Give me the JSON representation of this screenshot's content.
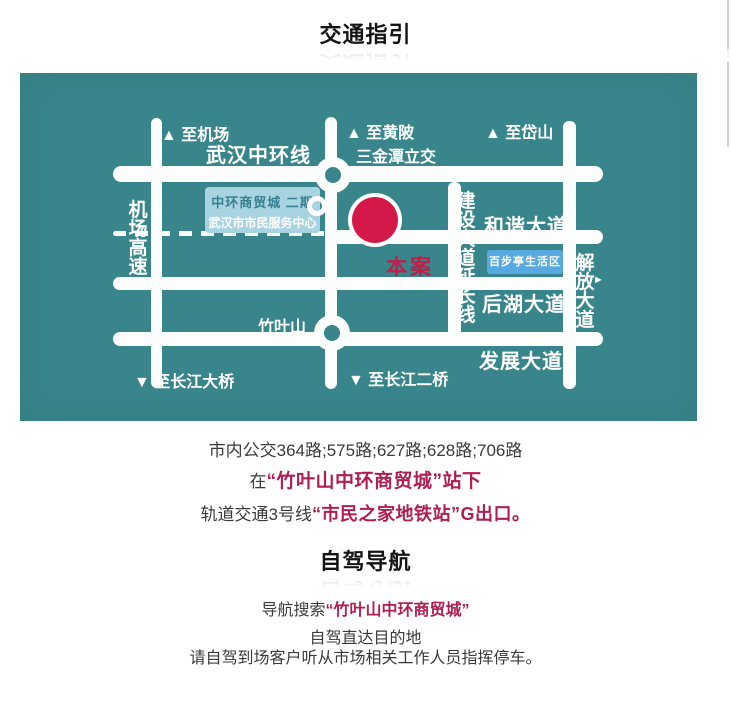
{
  "traffic_section": {
    "heading": "交通指引",
    "bus_line": "市内公交364路;575路;627路;628路;706路",
    "stop_line": {
      "prefix": "在",
      "highlight": "“竹叶山中环商贸城”站下"
    },
    "metro_line": {
      "prefix": "轨道交通3号线",
      "highlight": "“市民之家地铁站”G出口。"
    }
  },
  "driving_section": {
    "heading": "自驾导航",
    "nav_line": {
      "prefix": "导航搜索",
      "highlight": "“竹叶山中环商贸城”"
    },
    "direct_line": "自驾直达目的地",
    "note_line": "请自驾到场客户听从市场相关工作人员指挥停车。"
  },
  "map": {
    "colors": {
      "background": "#38858B",
      "road": "#FCFDFD",
      "site_marker": "#D4194A",
      "site_label": "#BE1E47",
      "info_box1_bg": "#A8D3E0",
      "info_box1_title": "#37808F",
      "info_box2_bg": "#58A9DF"
    },
    "labels": {
      "to_airport": "▲ 至机场",
      "wuhan_mid_ring": "武汉中环线",
      "to_huangpi": "▲ 至黄陂",
      "sanjintan_interchange": "三金潭立交",
      "to_daishan": "▲ 至岱山",
      "airport_expressway": "机场高速",
      "info_box1_title": "中环商贸城 二期",
      "info_box1_subtitle": "武汉市市民服务中心",
      "site_marker": "本案",
      "jianshe_ave_extension": "建设大道延长线",
      "harmony_ave": "和谐大道",
      "baibuting_area": "百步亭生活区",
      "jiefang_ave": "解放大道",
      "jiefang_arrow": "►",
      "houhu_ave": "后湖大道",
      "zhuyeshan": "竹叶山",
      "fazhan_ave": "发展大道",
      "to_changjiang_bridge": "▼ 至长江大桥",
      "to_changjiang_second_bridge": "▼ 至长江二桥"
    }
  },
  "ui": {
    "scrollbar_color": "#CFCFCF",
    "text_dark": "#3A3A3A",
    "accent_red": "#AE1E52"
  }
}
